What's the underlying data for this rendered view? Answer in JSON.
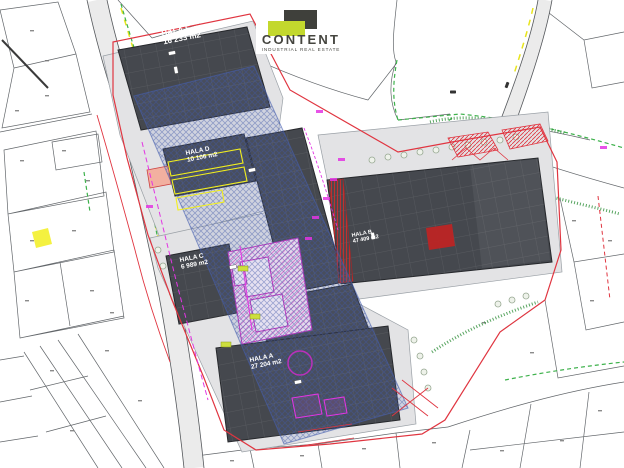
{
  "logo": {
    "brand": "CONTENT",
    "tagline": "INDUSTRIAL REAL ESTATE"
  },
  "halls": [
    {
      "id": "hala-e",
      "label": "HALA E",
      "area": "16 233 m2"
    },
    {
      "id": "hala-d",
      "label": "HALA D",
      "area": "10 106 m2"
    },
    {
      "id": "hala-c",
      "label": "HALA C",
      "area": "6 989 m2"
    },
    {
      "id": "hala-b",
      "label": "HALA B",
      "area": "47 409 m2"
    },
    {
      "id": "hala-a",
      "label": "HALA A",
      "area": "27 204 m2"
    }
  ],
  "colors": {
    "brand_green": "#c3d82d",
    "logo_dark": "#3f403b",
    "hall_roof": "#45484e",
    "overlay_blue": "#4a5fae",
    "boundary_red": "#e03540",
    "accent_magenta": "#e335e3",
    "vegetation_green": "#3db14b",
    "parking_yellow": "#f2ef1f",
    "pavement_gray": "#e3e3e5"
  }
}
